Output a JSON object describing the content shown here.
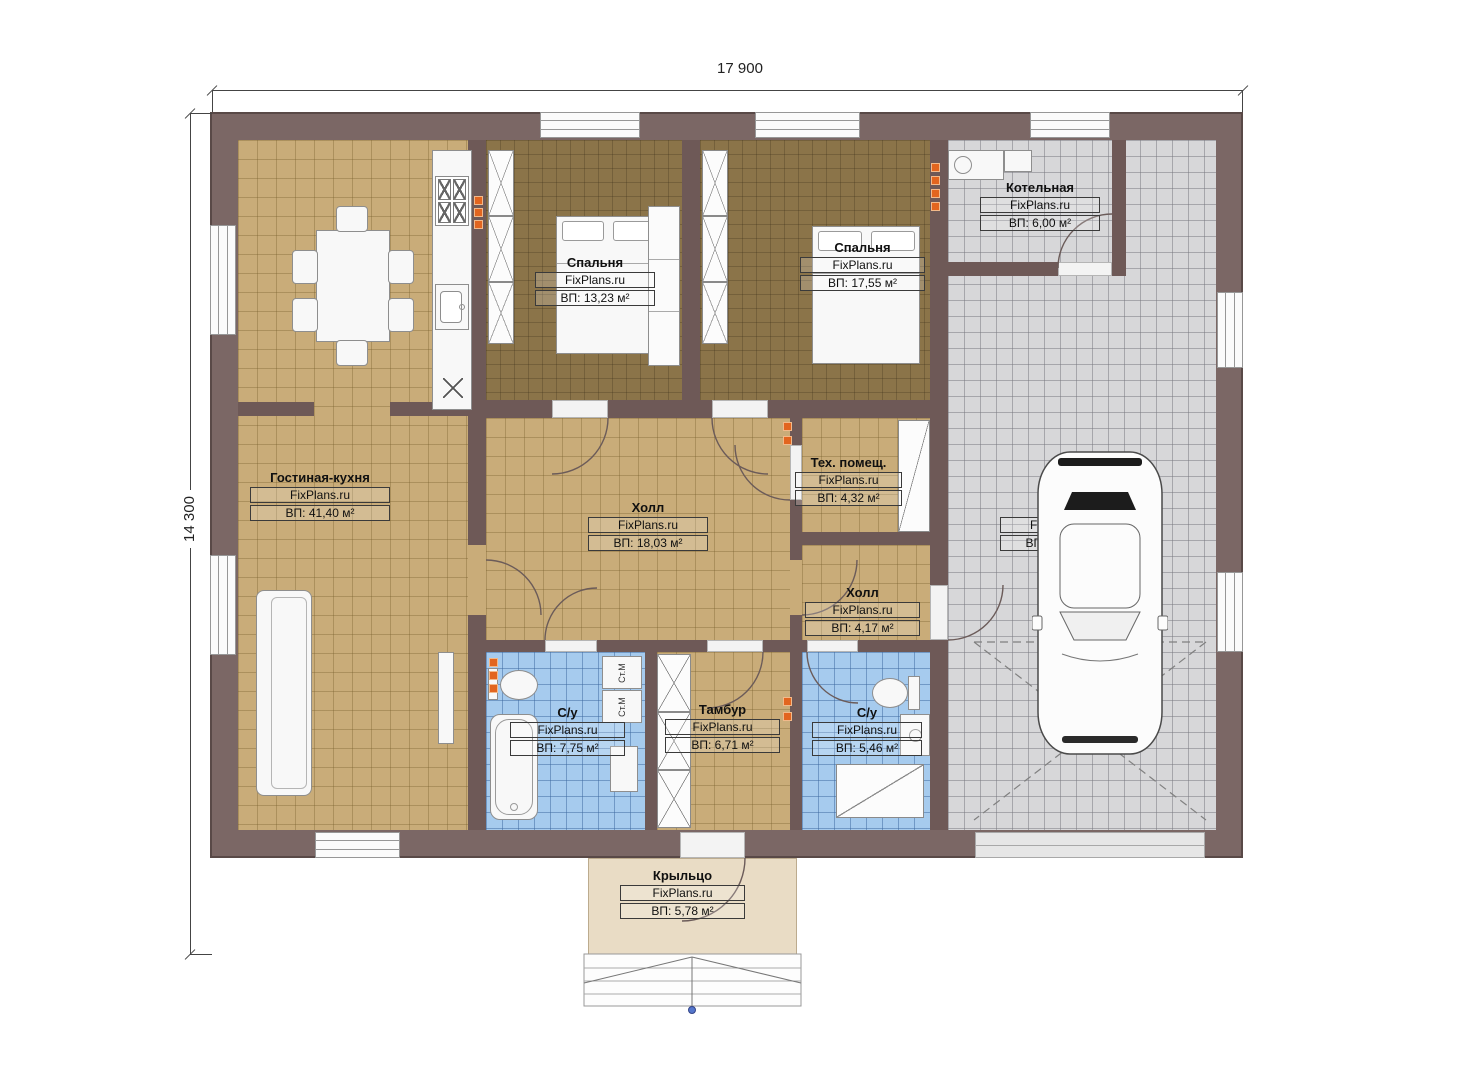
{
  "dimensions": {
    "width": "17 900",
    "height": "14 300"
  },
  "site": "FixPlans.ru",
  "rooms": [
    {
      "name": "Гостиная-кухня",
      "site": "FixPlans.ru",
      "area": "ВП: 41,40 м²"
    },
    {
      "name": "Спальня",
      "site": "FixPlans.ru",
      "area": "ВП: 13,23 м²"
    },
    {
      "name": "Спальня",
      "site": "FixPlans.ru",
      "area": "ВП: 17,55 м²"
    },
    {
      "name": "Котельная",
      "site": "FixPlans.ru",
      "area": "ВП: 6,00 м²"
    },
    {
      "name": "Холл",
      "site": "FixPlans.ru",
      "area": "ВП: 18,03 м²"
    },
    {
      "name": "Тех. помещ.",
      "site": "FixPlans.ru",
      "area": "ВП: 4,32 м²"
    },
    {
      "name": "Холл",
      "site": "FixPlans.ru",
      "area": "ВП: 4,17 м²"
    },
    {
      "name": "Гараж",
      "site": "FixPlans.ru",
      "area": "ВП: 48,69 м²"
    },
    {
      "name": "С/у",
      "site": "FixPlans.ru",
      "area": "ВП: 7,75 м²"
    },
    {
      "name": "Тамбур",
      "site": "FixPlans.ru",
      "area": "ВП: 6,71 м²"
    },
    {
      "name": "С/у",
      "site": "FixPlans.ru",
      "area": "ВП: 5,46 м²"
    },
    {
      "name": "Крыльцо",
      "site": "FixPlans.ru",
      "area": "ВП: 5,78 м²"
    }
  ],
  "labels": {
    "washer": "Ст.М"
  },
  "colors": {
    "wall": "#7b6765",
    "floor_tan": "#c9ac79",
    "floor_brown": "#8b7449",
    "floor_grey": "#d7d7d9",
    "floor_blue": "#a6cbee",
    "porch": "#e9dcc5",
    "vent": "#e2651f"
  }
}
